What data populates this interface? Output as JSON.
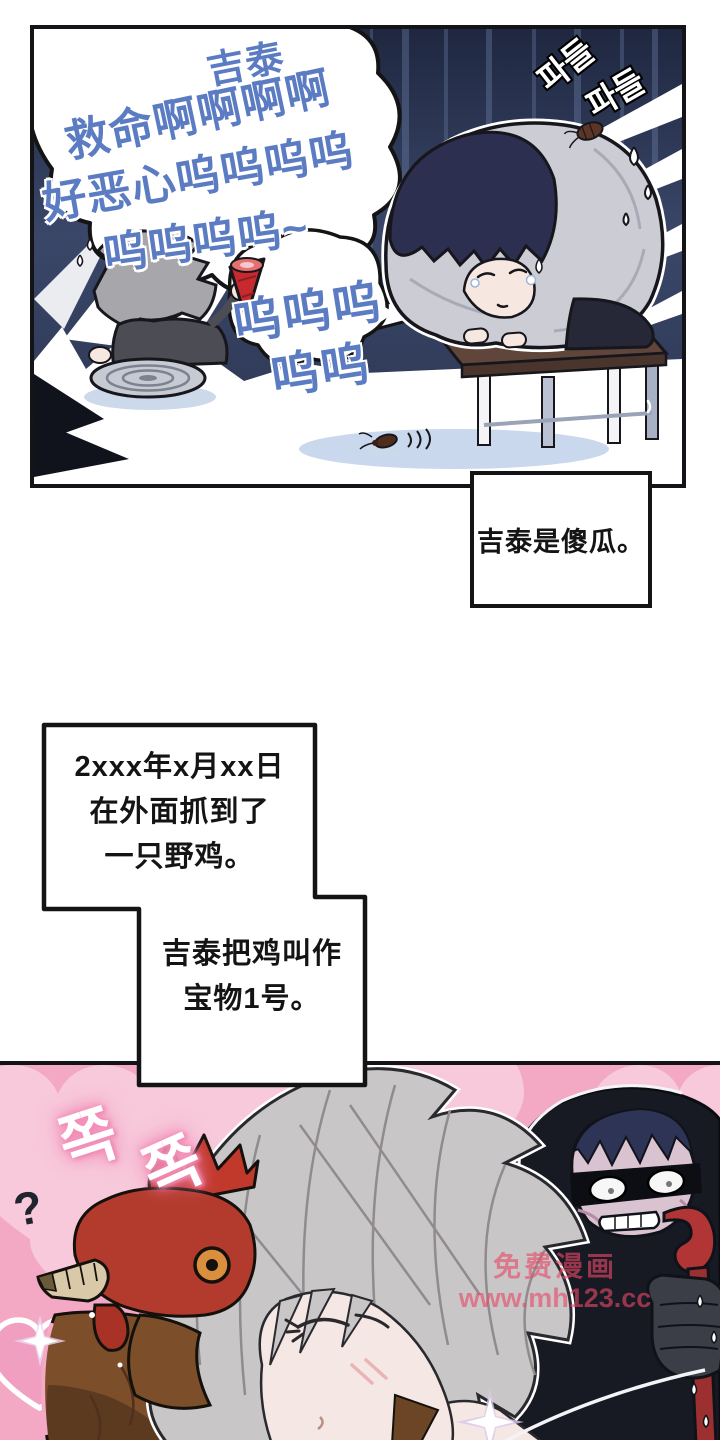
{
  "panel1": {
    "scream_bubble": {
      "lines": [
        "吉泰",
        "救命啊啊啊啊",
        "好恶心呜呜呜呜",
        "呜呜呜呜~"
      ]
    },
    "sob_bubble": {
      "lines": [
        "呜呜呜",
        "呜呜"
      ]
    },
    "sfx": {
      "tremble_1": "파들",
      "tremble_2": "파들"
    }
  },
  "captions": {
    "fool": "吉泰是傻瓜。",
    "date": {
      "lines": [
        "2xxx年x月xx日",
        "在外面抓到了",
        "一只野鸡。"
      ]
    },
    "name": {
      "lines": [
        "吉泰把鸡叫作",
        "宝物1号。"
      ]
    }
  },
  "panel2": {
    "sfx": {
      "kiss_1": "쪽",
      "kiss_2": "쪽",
      "question": "?"
    },
    "watermark": {
      "lines": [
        "免费漫画",
        "www.mh123.cc"
      ]
    }
  },
  "colors": {
    "scream_text_blue": "#5b7cc2",
    "panel1_bg_navy": "#2c3650",
    "panel2_bg_pink": "#f3a8c3",
    "heart_pink": "#f7c9da",
    "watermark_red": "#e94967",
    "blanket_gray": "#cbccd4",
    "bench_brown": "#5f453a",
    "rooster_red": "#b33b2d",
    "rooster_brown": "#7d4e2a",
    "crowbar_red": "#b23535"
  }
}
